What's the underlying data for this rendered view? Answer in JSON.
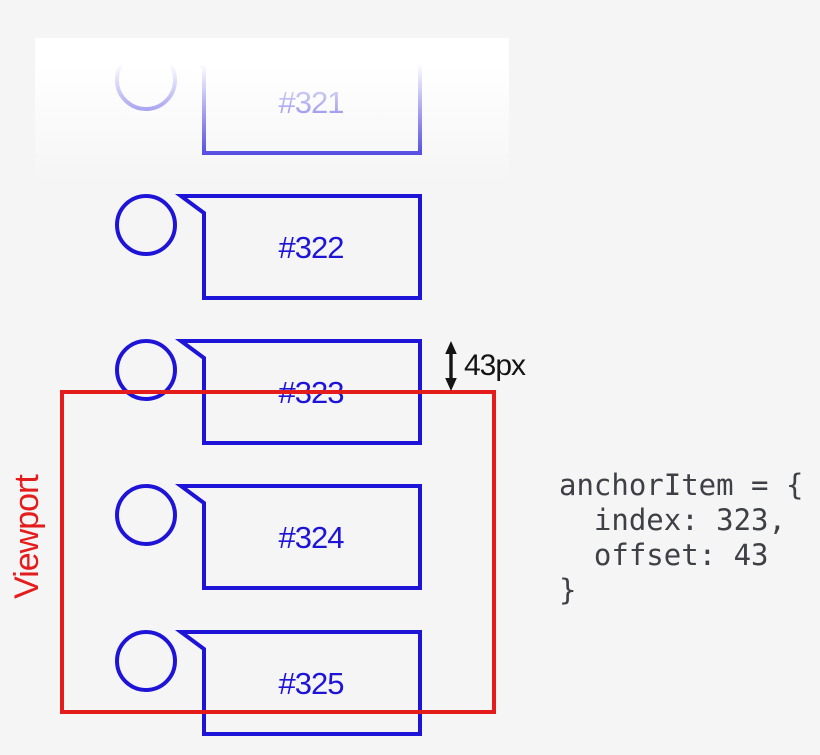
{
  "colors": {
    "item": "#1e14d8",
    "viewport": "#e51c1c",
    "annotation": "#141414",
    "code": "#3f4045",
    "background": "#f5f5f6"
  },
  "items": [
    {
      "label": "#321"
    },
    {
      "label": "#322"
    },
    {
      "label": "#323"
    },
    {
      "label": "#324"
    },
    {
      "label": "#325"
    }
  ],
  "viewport": {
    "label": "Viewport"
  },
  "measurement": {
    "label": "43px"
  },
  "code": {
    "text": "anchorItem = {\n  index: 323,\n  offset: 43\n}"
  }
}
